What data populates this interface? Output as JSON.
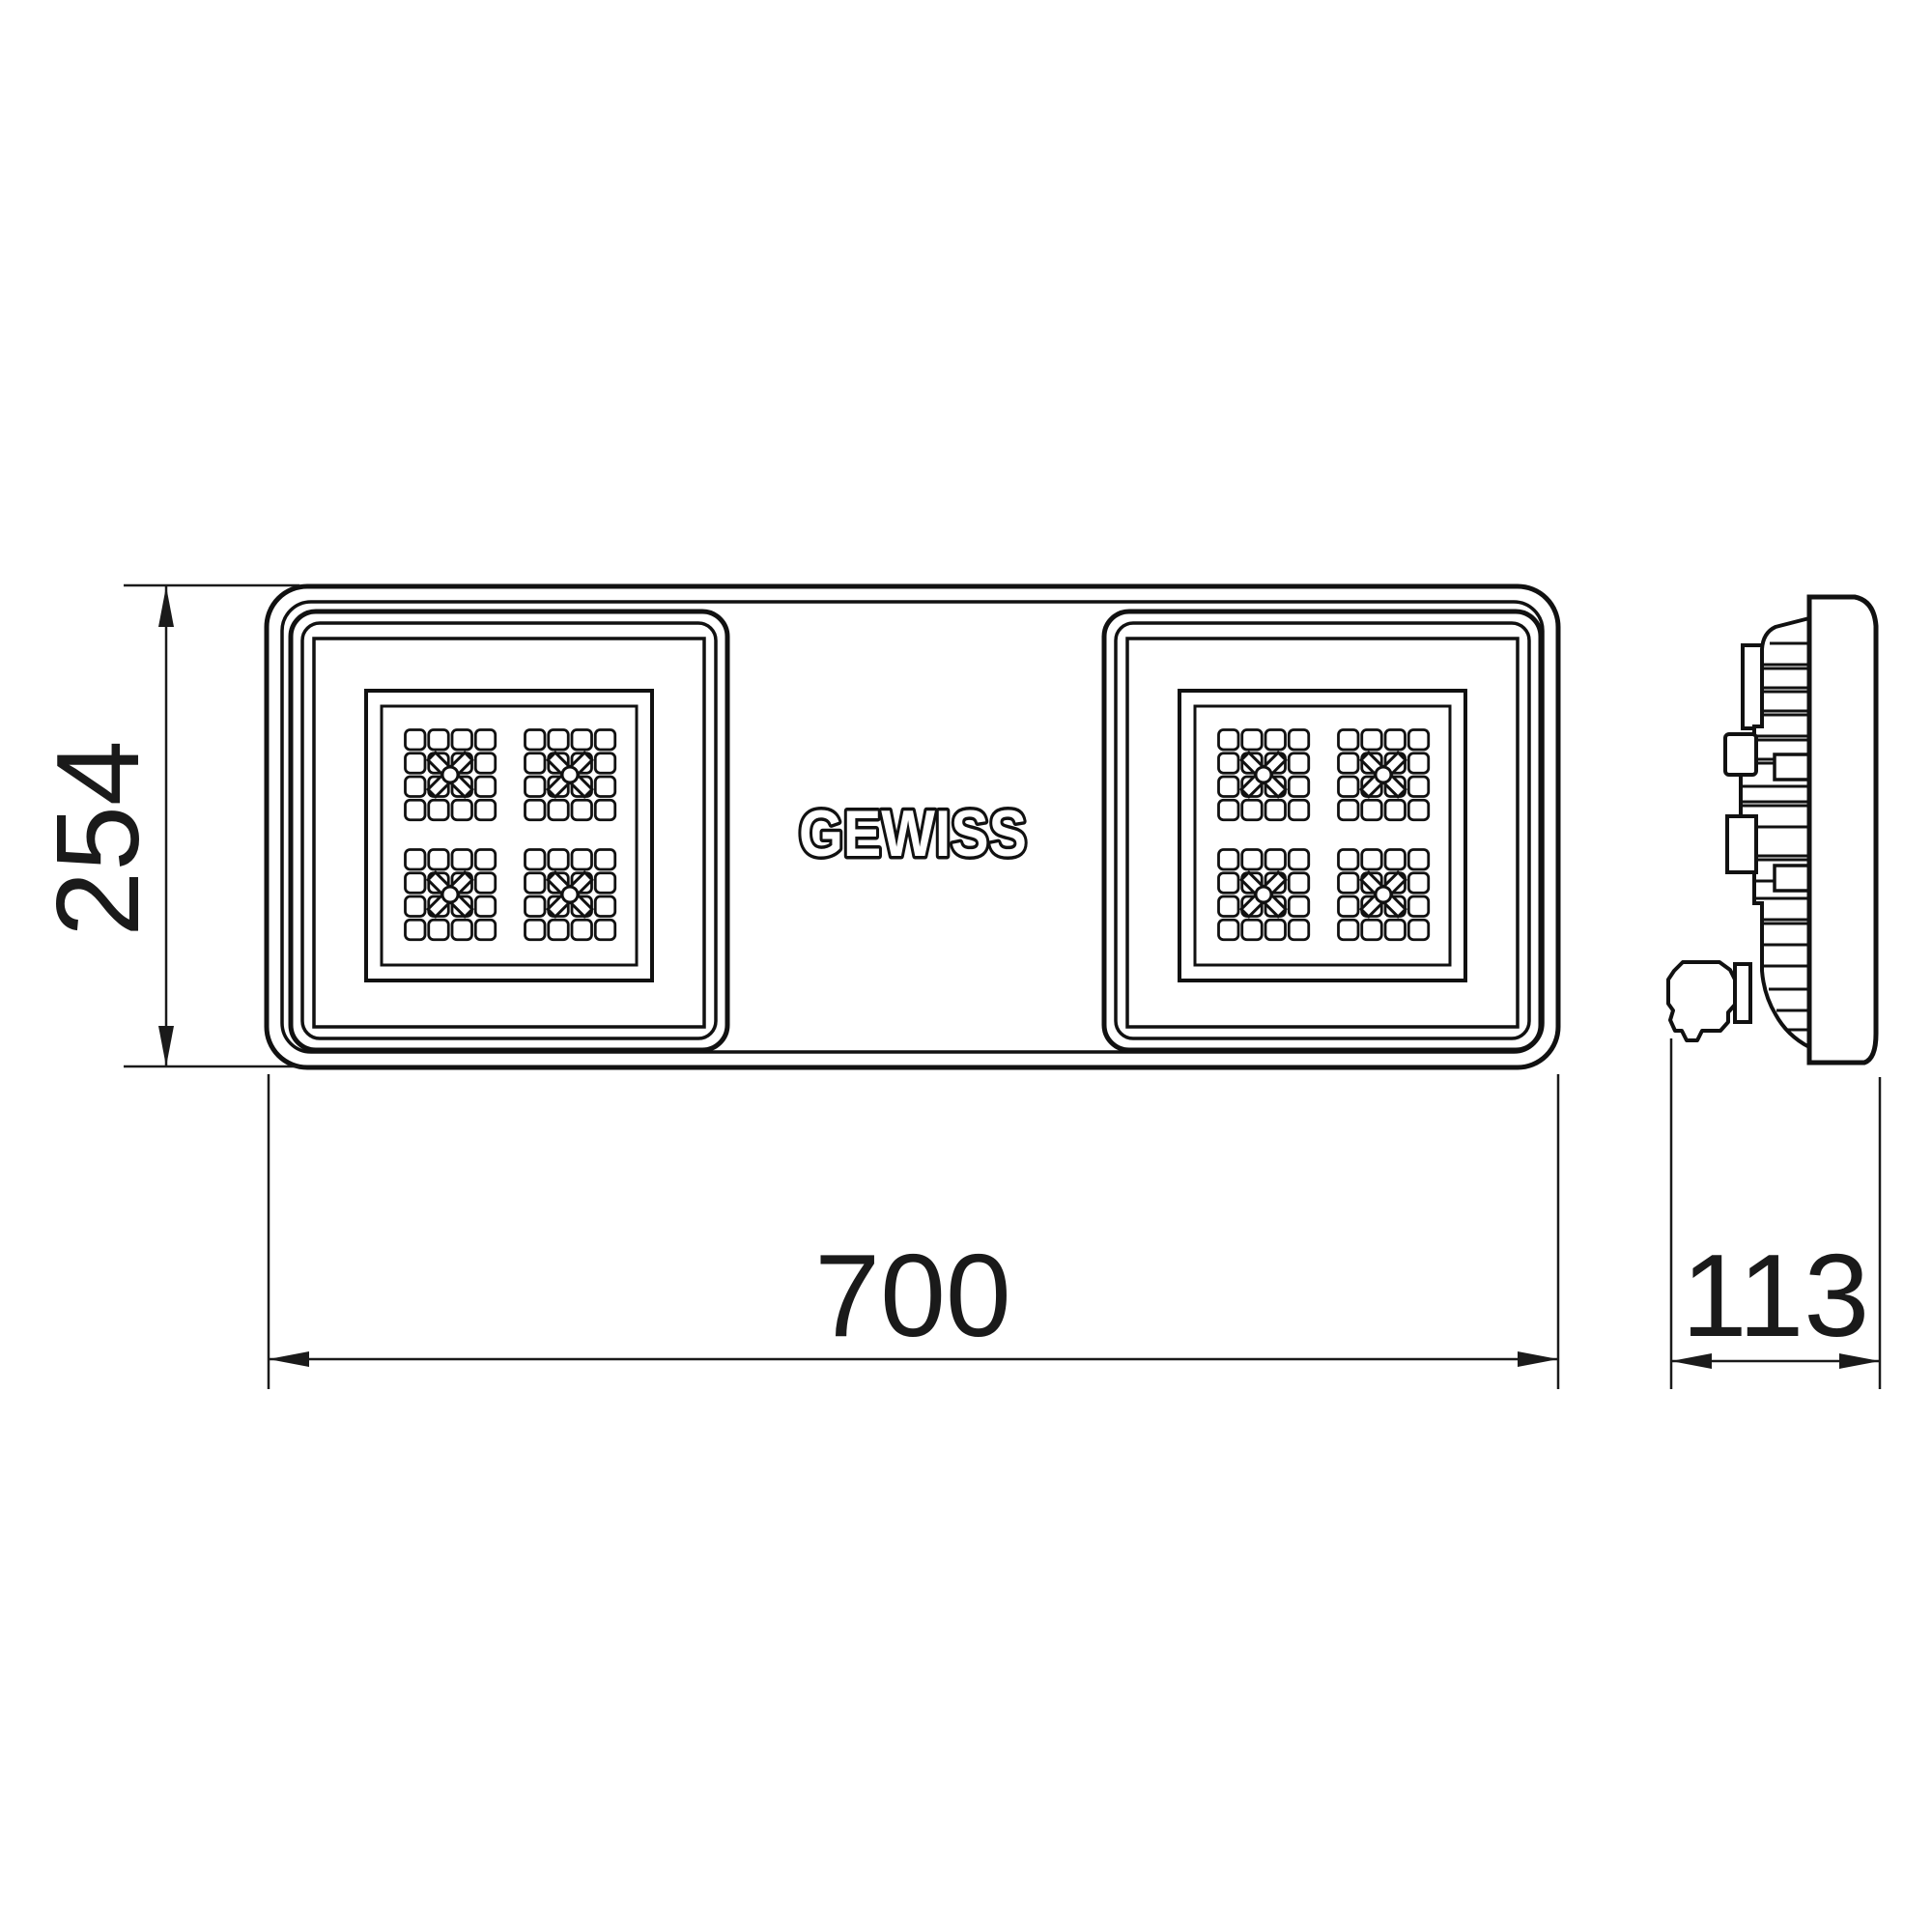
{
  "drawing": {
    "logo": "GEWISS",
    "dimensions": {
      "height": "254",
      "width": "700",
      "depth": "113"
    },
    "colors": {
      "line": "#111111",
      "background": "#ffffff"
    }
  }
}
